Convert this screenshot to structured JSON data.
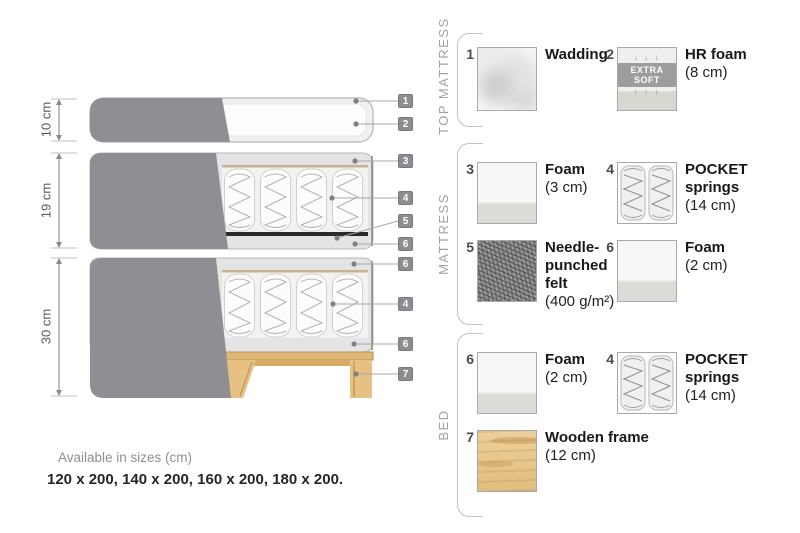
{
  "diagram": {
    "dimensions": [
      {
        "label": "10 cm"
      },
      {
        "label": "19 cm"
      },
      {
        "label": "30 cm"
      }
    ],
    "tags": [
      "1",
      "2",
      "3",
      "4",
      "5",
      "6",
      "6",
      "4",
      "6",
      "7"
    ]
  },
  "legend": {
    "sections": [
      {
        "title": "TOP MATTRESS",
        "items": [
          {
            "num": "1",
            "name": "Wadding",
            "size": ""
          },
          {
            "num": "2",
            "name": "HR foam",
            "size": "(8 cm)",
            "badge": "EXTRA SOFT",
            "arrows_down": "↓ ↓ ↓",
            "arrows_up": "↑ ↑ ↑"
          }
        ]
      },
      {
        "title": "MATTRESS",
        "items": [
          {
            "num": "3",
            "name": "Foam",
            "size": "(3 cm)"
          },
          {
            "num": "4",
            "name": "POCKET springs",
            "size": "(14 cm)"
          },
          {
            "num": "5",
            "name": "Needle-punched felt",
            "size": "(400 g/m²)"
          },
          {
            "num": "6",
            "name": "Foam",
            "size": "(2 cm)"
          }
        ]
      },
      {
        "title": "BED",
        "items": [
          {
            "num": "6",
            "name": "Foam",
            "size": "(2 cm)"
          },
          {
            "num": "4",
            "name": "POCKET springs",
            "size": "(14 cm)"
          },
          {
            "num": "7",
            "name": "Wooden frame",
            "size": "(12 cm)"
          }
        ]
      }
    ]
  },
  "footer": {
    "line1": "Available in sizes (cm)",
    "line2": "120 x 200, 140 x 200, 160 x 200, 180 x 200."
  },
  "colors": {
    "fabric_gray": "#8f8f93",
    "casing_gray": "#e4e4e6",
    "felt_black": "#2a2a2a",
    "wood_tan": "#e3c48e",
    "tag_gray": "#8d8d91"
  }
}
